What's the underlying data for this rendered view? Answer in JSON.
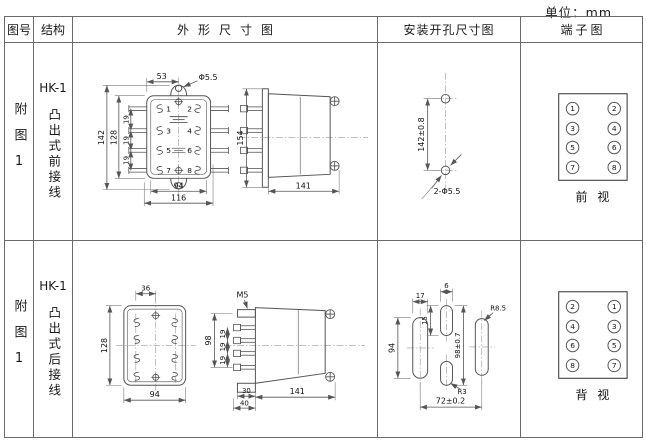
{
  "unit_label": "单位：mm",
  "header": {
    "figure": "图号",
    "structure": "结构",
    "outline": "外形尺寸图",
    "mounting": "安装开孔尺寸图",
    "terminal": "端子图"
  },
  "rows": [
    {
      "figure_label": "附图1",
      "model": "HK-1",
      "structure_label": "凸出式前接线",
      "outline": {
        "front": {
          "dim_top": "53",
          "hole_label": "Φ5.5",
          "dim_height_outer": "142",
          "dim_height_inner": "128",
          "pitch": [
            "19",
            "19",
            "19"
          ],
          "dim_width_inner": "94",
          "dim_width_outer": "116",
          "terminals": [
            "1",
            "2",
            "3",
            "4",
            "5",
            "6",
            "7",
            "8"
          ]
        },
        "side": {
          "dim_height": "154",
          "dim_depth": "141"
        }
      },
      "mounting": {
        "dim_vertical": "142±0.8",
        "holes_label": "2-Φ5.5"
      },
      "terminal": {
        "numbers": [
          "1",
          "2",
          "3",
          "4",
          "5",
          "6",
          "7",
          "8"
        ],
        "view_label": "前视"
      }
    },
    {
      "figure_label": "附图1",
      "model": "HK-1",
      "structure_label": "凸出式后接线",
      "outline": {
        "front": {
          "dim_top": "36",
          "dim_height": "128",
          "dim_width": "94"
        },
        "side": {
          "screw_label": "M5",
          "dim_height": "98",
          "pitch": [
            "19",
            "19",
            "19"
          ],
          "dim_base_inner": "30",
          "dim_base_outer": "40",
          "dim_depth": "141"
        }
      },
      "mounting": {
        "slot_width": "17",
        "slot_height": "94",
        "center_slot_width": "6",
        "center_slot_height": "15",
        "dim_vertical": "98±0.7",
        "radius_large": "R8.5",
        "radius_small": "R3",
        "dim_horizontal": "72±0.2"
      },
      "terminal": {
        "numbers": [
          "2",
          "1",
          "4",
          "3",
          "6",
          "5",
          "8",
          "7"
        ],
        "view_label": "背视"
      }
    }
  ]
}
